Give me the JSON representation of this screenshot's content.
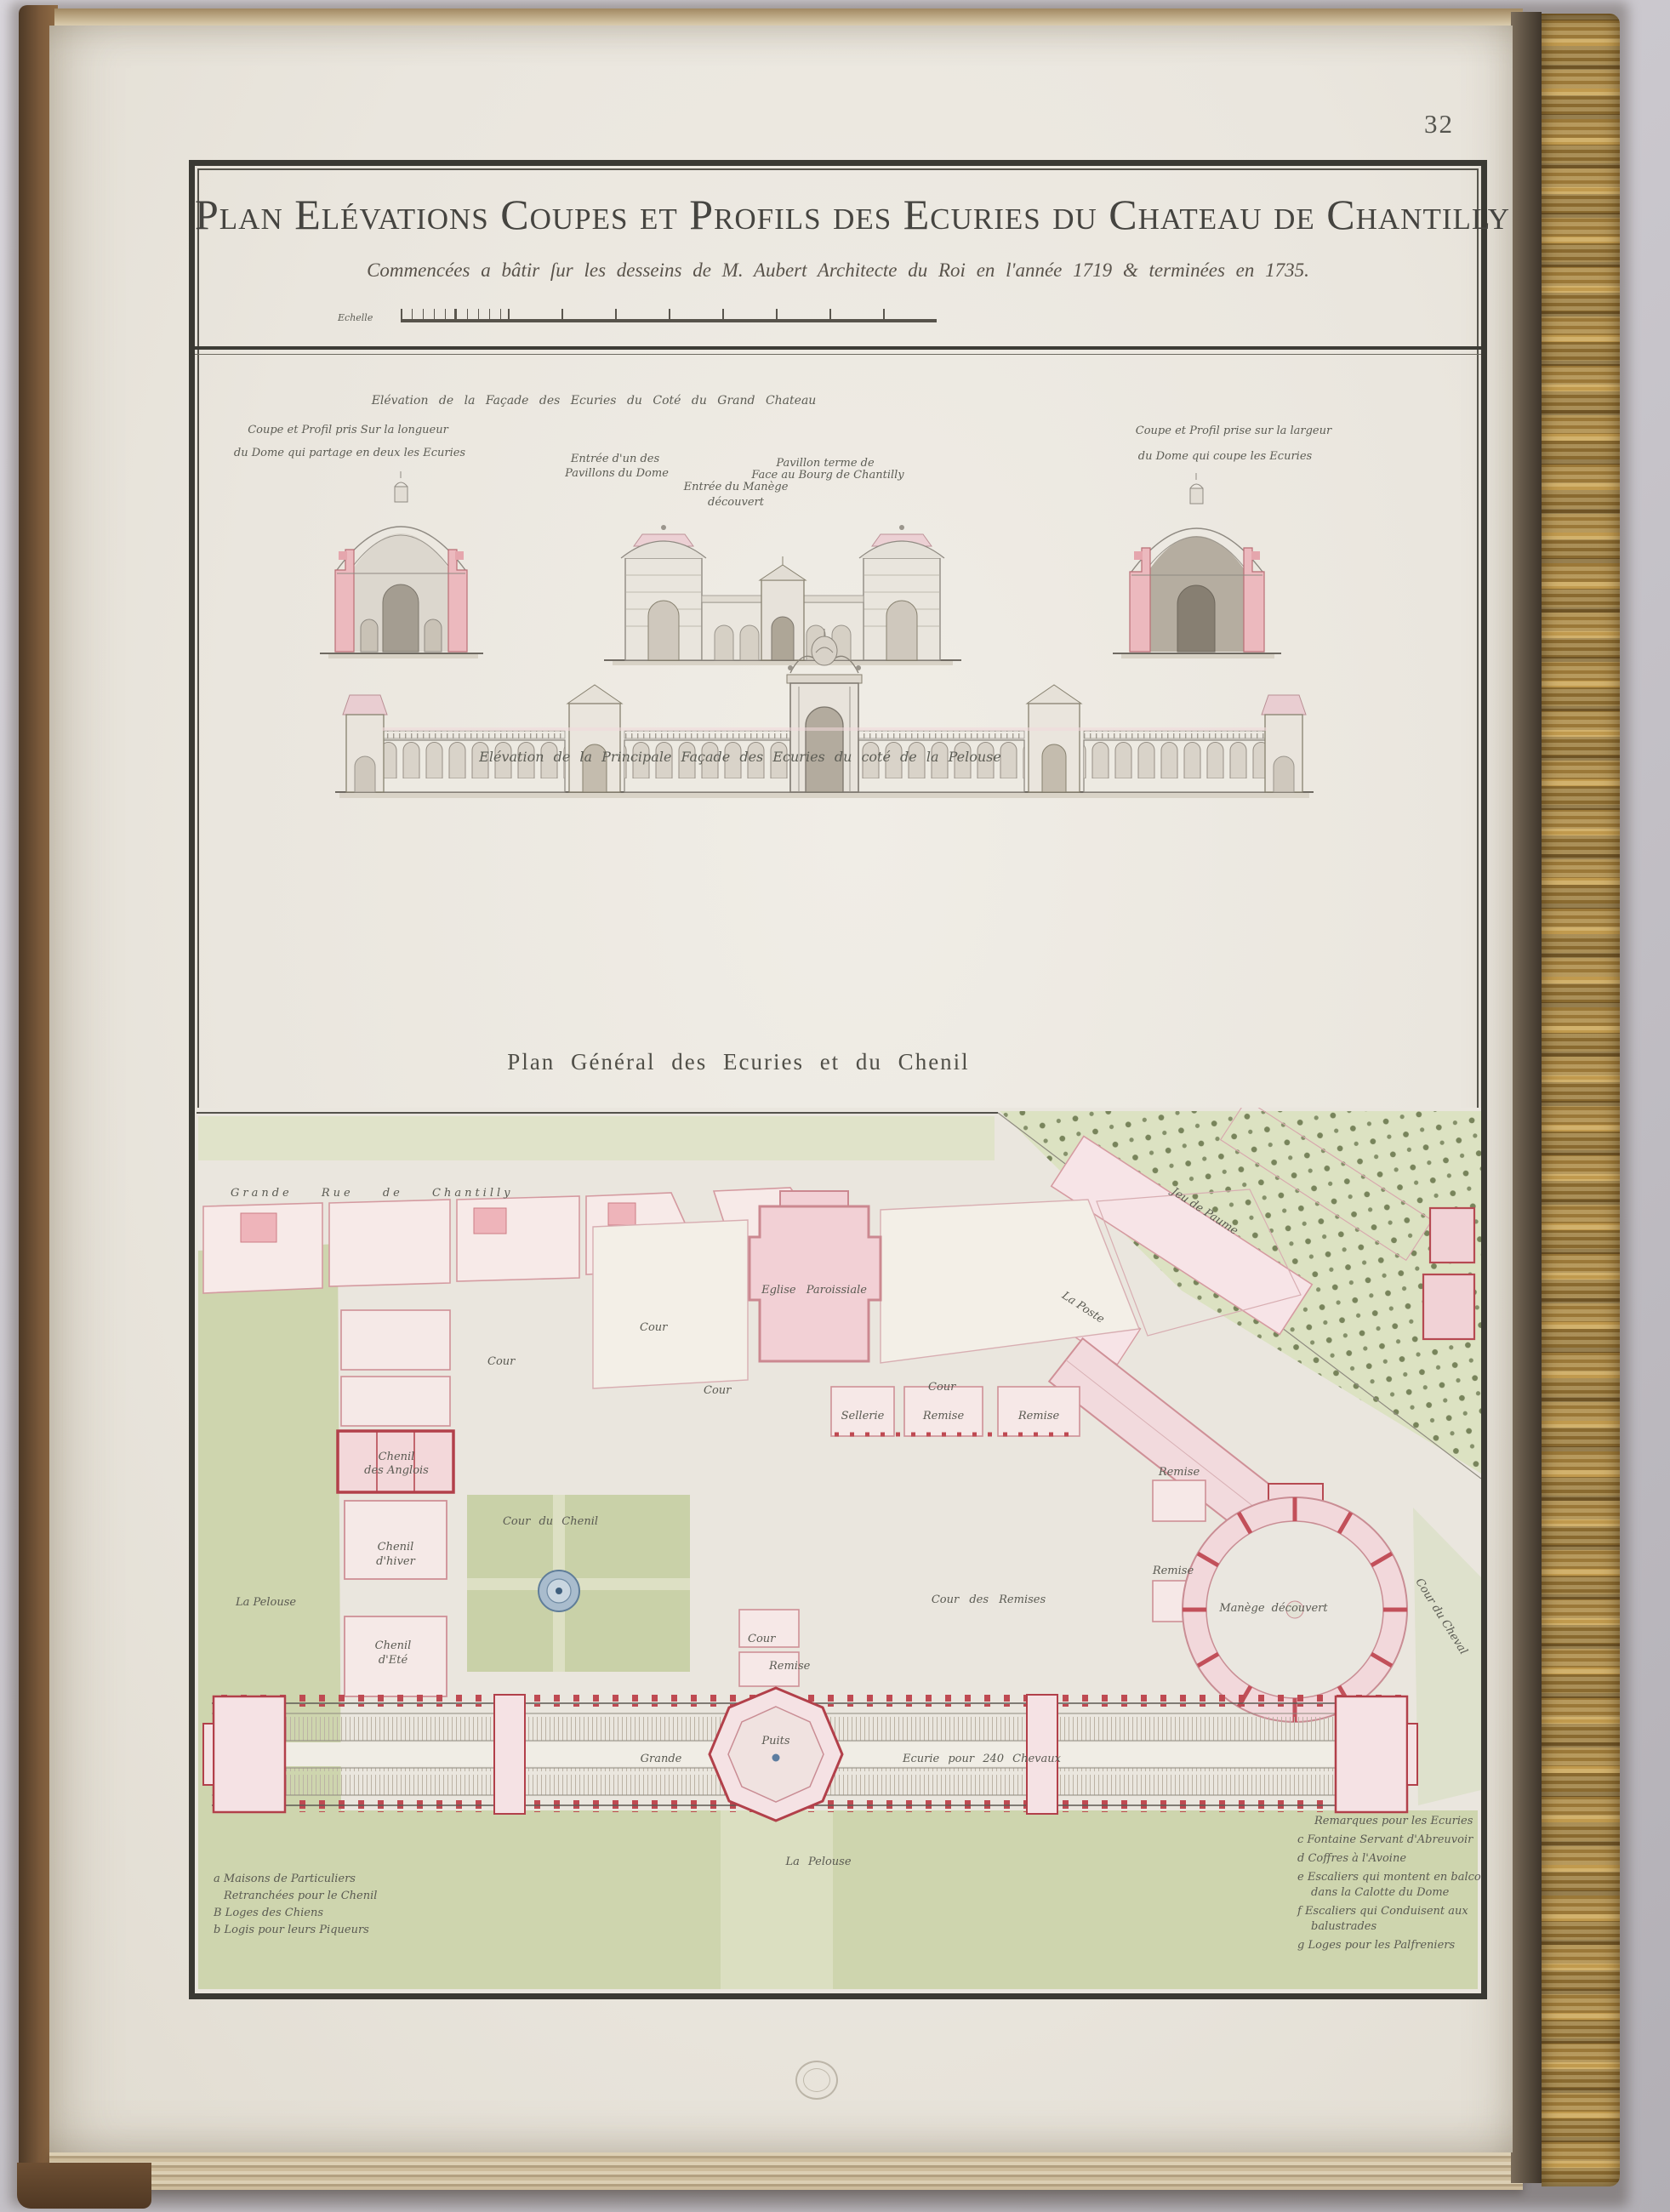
{
  "page": {
    "folio": "32"
  },
  "title_block": {
    "title": "Plan Elévations Coupes et Profils des Ecuries du Chateau de Chantilly",
    "subtitle": "Commencées a bâtir ſur les desseins de M. Aubert Architecte du Roi en l'année 1719 & terminées en 1735.",
    "scale_label": "Echelle"
  },
  "elevations": {
    "left_section": {
      "caption_1": "Coupe et Profil pris Sur la longueur",
      "caption_2": "du Dome qui partage en deux les Ecuries"
    },
    "court_facade": {
      "caption": "Elévation de la Façade des Ecuries du Coté du Grand Chateau",
      "entrance_1": "Entrée d'un des",
      "entrance_2": "Pavillons du Dome",
      "manege_1": "Entrée du Manège",
      "manege_2": "découvert",
      "pavilion_1": "Pavillon terme de",
      "pavilion_2": "Face au Bourg de Chantilly"
    },
    "right_section": {
      "caption_1": "Coupe et Profil prise sur la largeur",
      "caption_2": "du Dome qui coupe les Ecuries"
    },
    "main_facade_caption": "Elévation de la Principale Façade des Ecuries du coté de la Pelouse"
  },
  "plan": {
    "caption": "Plan Général des Ecuries et du Chenil",
    "labels": {
      "grande_rue": "Grande Rue de Chantilly",
      "jeu_de_paume": "Jeu de Paume",
      "la_poste": "La Poste",
      "eglise": "Eglise Paroissiale",
      "cour": "Cour",
      "remise": "Remise",
      "sellerie": "Sellerie",
      "cour_du_chenil": "Cour du Chenil",
      "chenil_anglois_1": "Chenil",
      "chenil_anglois_2": "des Anglois",
      "chenil_hiver_1": "Chenil",
      "chenil_hiver_2": "d'hiver",
      "chenil_ete_1": "Chenil",
      "chenil_ete_2": "d'Eté",
      "pelouse": "La Pelouse",
      "cour_des_remises": "Cour des Remises",
      "manege": "Manège découvert",
      "grande": "Grande",
      "ecurie": "Ecurie pour 240 Chevaux",
      "puits": "Puits",
      "cour_du_cheval": "Cour du Cheval"
    },
    "legend_left": {
      "line_a1": "a Maisons de Particuliers",
      "line_a2": "Retranchées pour le Chenil",
      "line_b1": "B Loges des Chiens",
      "line_b2": "b Logis pour leurs Piqueurs"
    },
    "legend_right": {
      "title": "Remarques pour les Ecuries",
      "line_c": "c Fontaine Servant d'Abreuvoir",
      "line_d": "d Coffres à l'Avoine",
      "line_e1": "e Escaliers qui montent en balcon",
      "line_e2": "dans la Calotte du Dome",
      "line_f1": "f Escaliers qui Conduisent aux",
      "line_f2": "balustrades",
      "line_g": "g Loges pour les Palfreniers"
    }
  },
  "colors": {
    "backdrop": "#c7c4ca",
    "paper": "#ebe7df",
    "ink": "#45443e",
    "hand_ink": "#5c5c54",
    "wash_pink": "#f3d6d9",
    "wall_red": "#b2404a",
    "lawn_green": "#ced5ae",
    "water_blue": "#7d97af",
    "gilt": "#a8843f"
  }
}
